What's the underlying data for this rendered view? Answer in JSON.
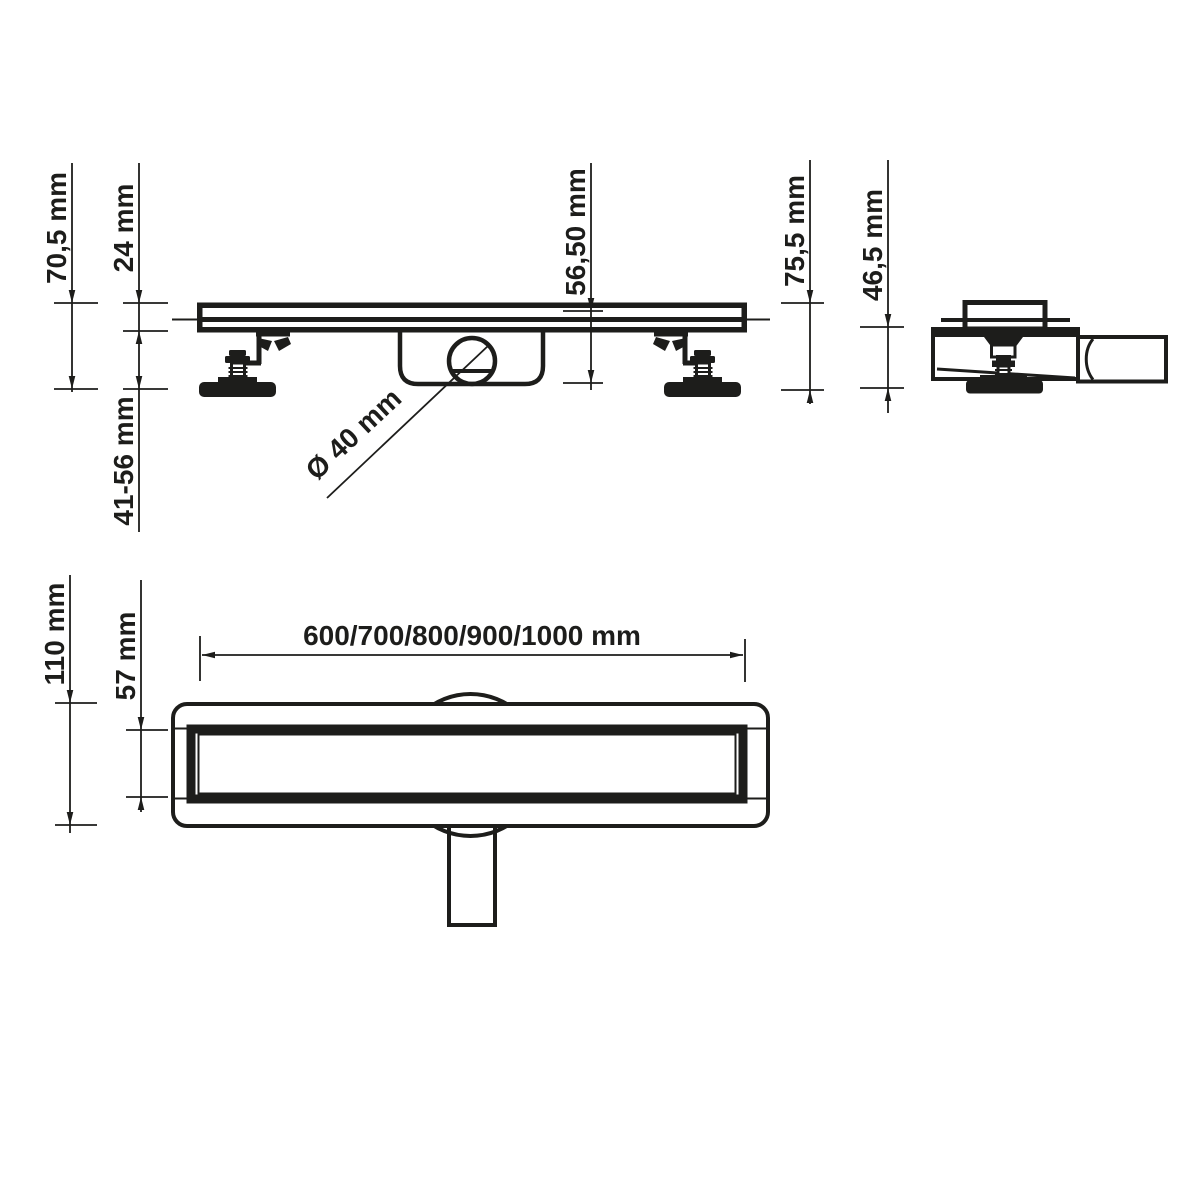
{
  "drawing": {
    "title": "linear shower drain technical drawing",
    "labels": {
      "total_height": "70,5 mm",
      "edge_height": "24 mm",
      "adjustable_feet_range": "41-56 mm",
      "trap_depth": "56,50 mm",
      "outlet_diameter": "Ø 40 mm",
      "end_total_height": "75,5 mm",
      "end_body_height": "46,5 mm",
      "available_lengths": "600/700/800/900/1000 mm",
      "flange_width": "110 mm",
      "grate_width": "57 mm"
    },
    "colors": {
      "line": "#1d1d1b",
      "background": "#ffffff"
    }
  }
}
